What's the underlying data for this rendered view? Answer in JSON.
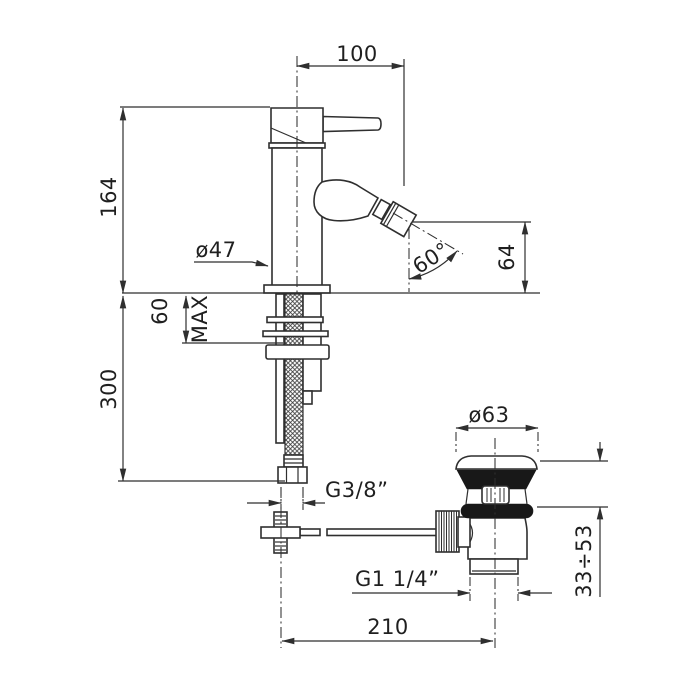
{
  "drawing": {
    "type": "technical-dimension-drawing",
    "subject": "single-lever bidet mixer with pop-up waste",
    "colors": {
      "background": "#ffffff",
      "line": "#2f2f2f",
      "solid_fill": "#181818"
    },
    "labels": {
      "spout_projection": "100",
      "body_height": "164",
      "body_diameter": "ø47",
      "spout_angle": "60°",
      "spout_outlet_height": "64",
      "deck_thickness": "60",
      "deck_thickness_suffix": "MAX",
      "under_deck_hose_length": "300",
      "supply_hose_thread": "G3/8”",
      "waste_flange_diameter": "ø63",
      "waste_body_thread": "G1 1/4”",
      "waste_clamp_range": "33÷53",
      "drain_offset": "210"
    }
  }
}
